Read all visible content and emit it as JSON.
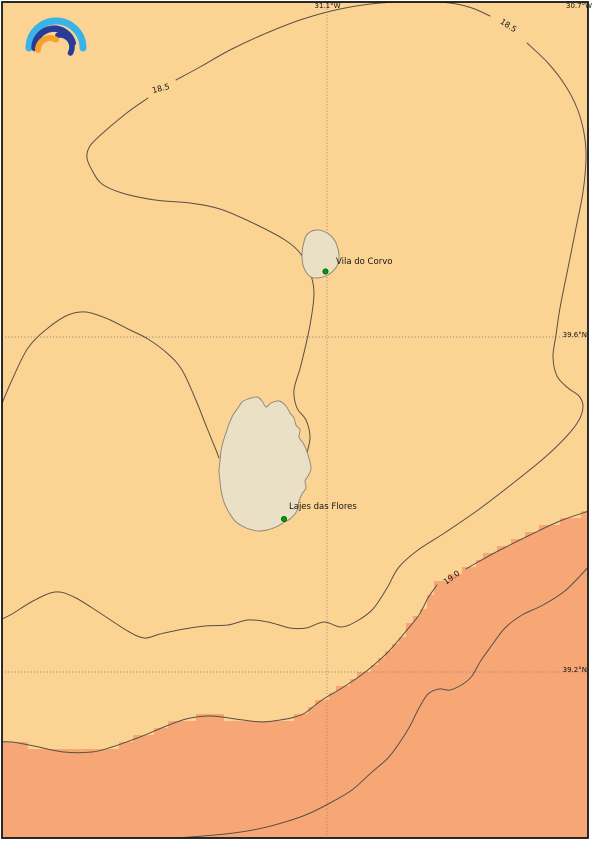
{
  "map": {
    "logo_icon": "rainbow-arcs-logo",
    "marker_icon": "green-station-dot"
  },
  "axis_labels": {
    "lon_left": "31.1°W",
    "lon_right": "30.7°W",
    "lat_upper": "39.6°N",
    "lat_lower": "39.2°N"
  },
  "contour_labels": {
    "cool_a": "18.5",
    "cool_b": "18.5",
    "warm": "19.0"
  },
  "places": {
    "corvo": "Vila do Corvo",
    "flores": "Lajes das Flores"
  },
  "colors": {
    "sea_cool": "#fbd494",
    "sea_warm": "#f7a776",
    "land": "#e9e0c5",
    "contour_line": "#5a4f45",
    "coastline": "#8a8274",
    "grid": "#8a8278",
    "frame": "#161616",
    "marker_green": "#00a000",
    "marker_edge": "#005200",
    "logo_cyan": "#3ab4e8",
    "logo_dark_blue": "#283c96",
    "logo_orange": "#f7a12e"
  }
}
